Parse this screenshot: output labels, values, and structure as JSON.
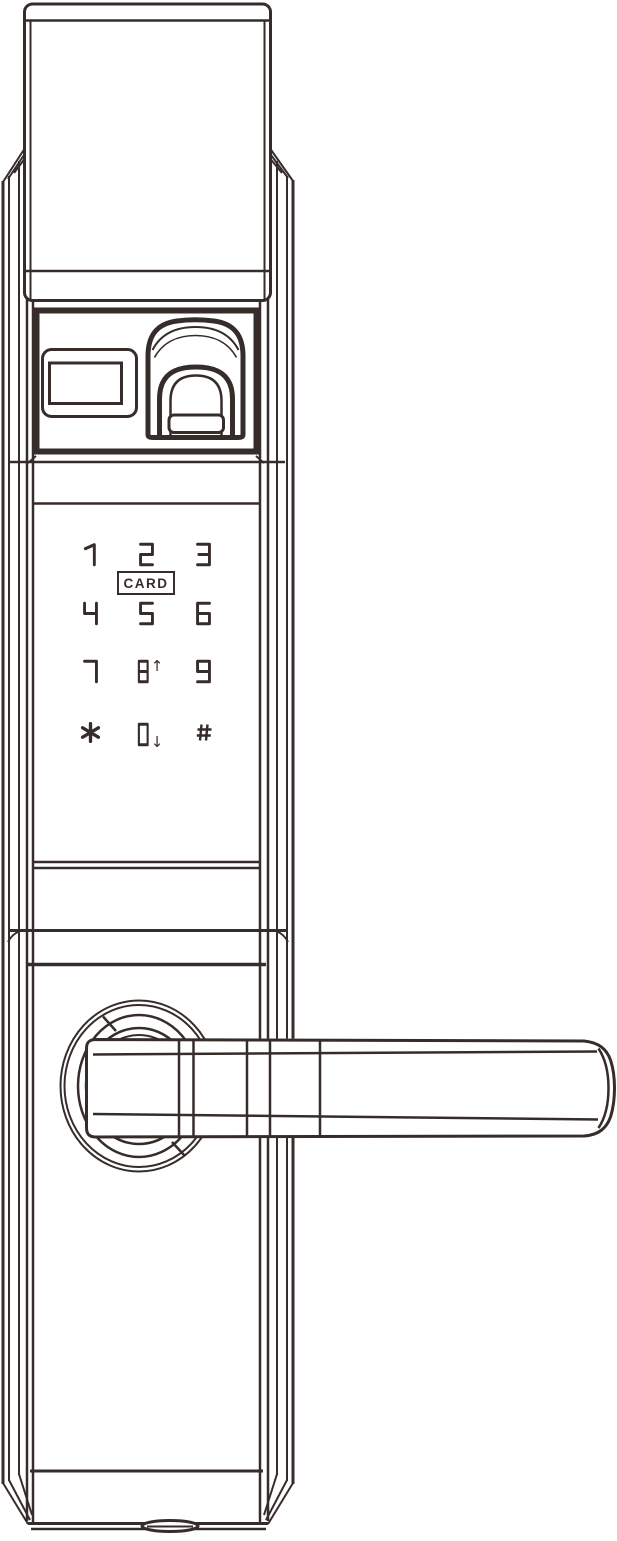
{
  "diagram": {
    "description": "Smart door lock front view line drawing",
    "line_color": "#362d2a",
    "background_color": "#ffffff"
  },
  "keypad": {
    "card_label": "CARD",
    "keys": [
      {
        "label": "1"
      },
      {
        "label": "2"
      },
      {
        "label": "3"
      },
      {
        "label": "4"
      },
      {
        "label": "5"
      },
      {
        "label": "6"
      },
      {
        "label": "7"
      },
      {
        "label": "8",
        "suffix": "↑"
      },
      {
        "label": "9"
      },
      {
        "label": "*"
      },
      {
        "label": "0",
        "suffix": "↓"
      },
      {
        "label": "#"
      }
    ]
  }
}
